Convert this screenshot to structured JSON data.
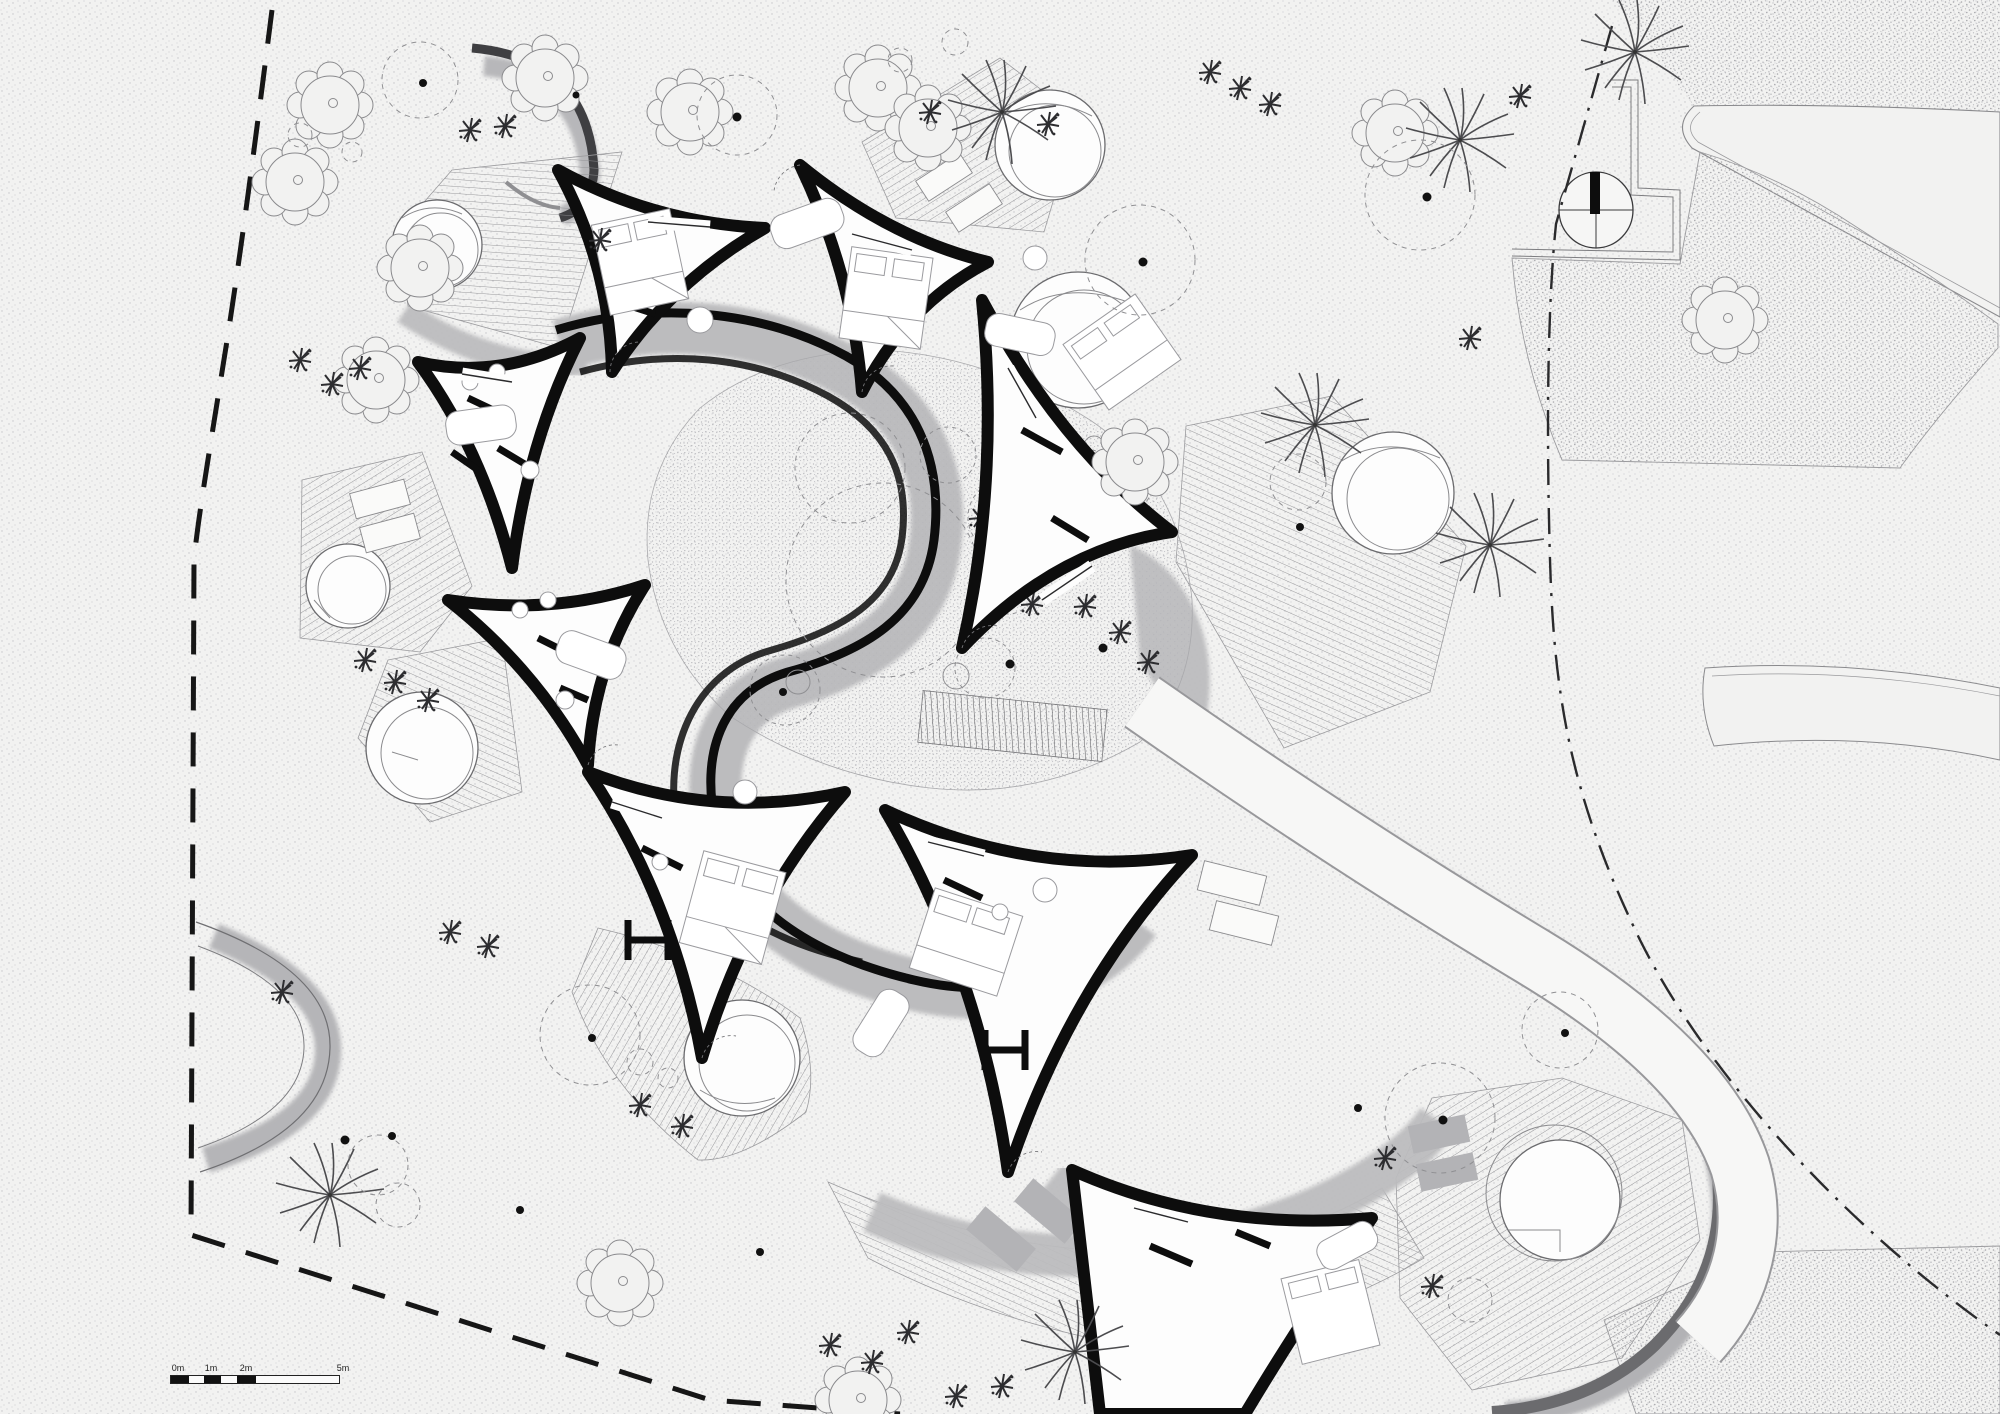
{
  "drawing": {
    "scale_bar": {
      "labels": [
        "0m",
        "1m",
        "2m",
        "5m"
      ]
    },
    "colors": {
      "paper": "#f2f2f1",
      "wall_ink": "#0d0d0d",
      "shadow_gray": "#bcbcbe",
      "hatch_gray": "#8f8f92",
      "stipple_gray": "#c4c4c8",
      "sand_gray": "#a8a8ac",
      "boundary_ink": "#161616",
      "vegetation_line": "#6d6d70"
    }
  }
}
